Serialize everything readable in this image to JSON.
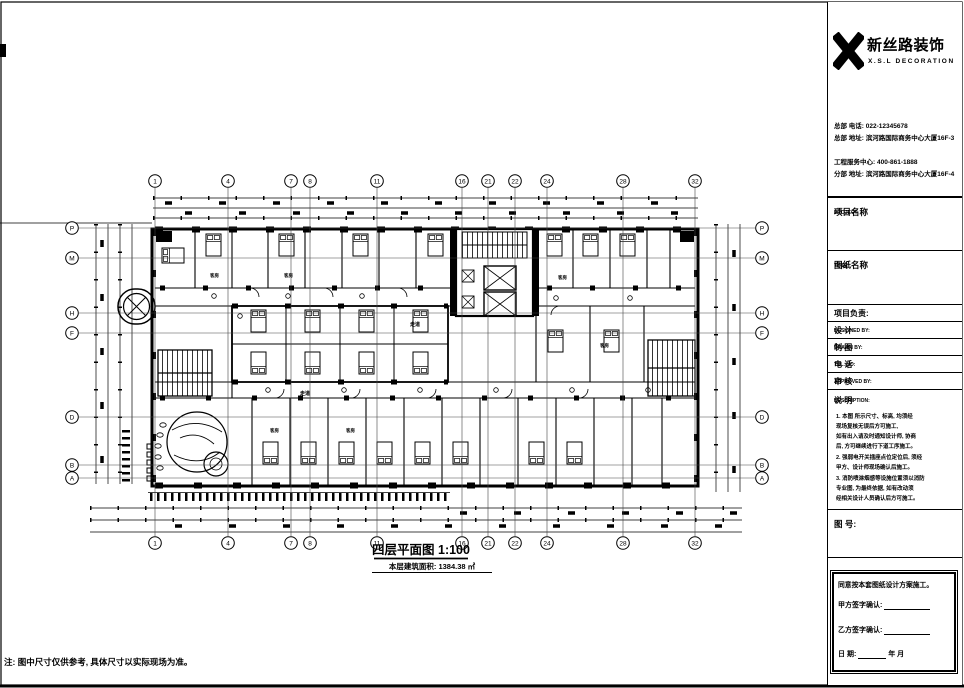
{
  "page": {
    "note": "注: 图中尺寸仅供参考, 具体尺寸以实际现场为准。"
  },
  "drawing": {
    "title": "四层平面图 1:100",
    "subtitle": "本层建筑面积: 1384.38 ㎡",
    "corridor_label": "走道",
    "room_label": "客房",
    "grid": {
      "cols": [
        {
          "x": 155,
          "label": "1"
        },
        {
          "x": 228,
          "label": "4"
        },
        {
          "x": 291,
          "label": "7"
        },
        {
          "x": 310,
          "label": "8"
        },
        {
          "x": 377,
          "label": "11"
        },
        {
          "x": 462,
          "label": "16"
        },
        {
          "x": 488,
          "label": "21"
        },
        {
          "x": 515,
          "label": "22"
        },
        {
          "x": 547,
          "label": "24"
        },
        {
          "x": 623,
          "label": "28"
        },
        {
          "x": 695,
          "label": "32"
        }
      ],
      "rows": [
        {
          "y": 228,
          "label": "P"
        },
        {
          "y": 258,
          "label": "M"
        },
        {
          "y": 313,
          "label": "H"
        },
        {
          "y": 333,
          "label": "F"
        },
        {
          "y": 417,
          "label": "D"
        },
        {
          "y": 465,
          "label": "B"
        },
        {
          "y": 478,
          "label": "A"
        }
      ]
    }
  },
  "panel": {
    "logo": {
      "cn": "新丝路装饰",
      "en": "X.S.L DECORATION"
    },
    "contact": [
      "总部 电话: 022-12345678",
      "总部 地址: 滨河路国际商务中心大厦16F-3",
      "工程服务中心: 400-861-1888",
      "分部 地址: 滨河路国际商务中心大厦16F-4"
    ],
    "project_label": "项目名称",
    "project_en": "PROJECT:",
    "sheet_label": "图纸名称",
    "sheet_en": "TITLE:",
    "rows": [
      {
        "cn": "项目负责:",
        "en": ""
      },
      {
        "cn": "设  计",
        "en": "DESIGNED BY:"
      },
      {
        "cn": "制  图",
        "en": "DRAWN BY:"
      },
      {
        "cn": "电  话",
        "en": "TEL. NO:"
      },
      {
        "cn": "审  核",
        "en": "APPROVED BY:"
      }
    ],
    "desc_label": "说  明",
    "desc_en": "DESCRIPTION:",
    "notes": [
      "1. 本图 所示尺寸、标高, 均须经",
      "    现场复核无误后方可施工,",
      "    如有出入请及时通知设计师, 协商",
      "    后, 方可继续进行下道工序施工。",
      "2. 强弱电开关插座点位定位后, 须经",
      "    甲方、设计师现场确认后施工。",
      "3. 消防喷淋烟感等设施位置须以消防",
      "    专业图, 为最终依据, 如有改动须",
      "    经相关设计人员确认后方可施工。"
    ],
    "sheet_no_label": "图  号:",
    "confirm": {
      "line1": "同意按本套图纸设计方案施工。",
      "party_a": "甲方签字确认:",
      "party_b": "乙方签字确认:",
      "date_label": "日          期:",
      "date_suffix": "年    月"
    }
  }
}
